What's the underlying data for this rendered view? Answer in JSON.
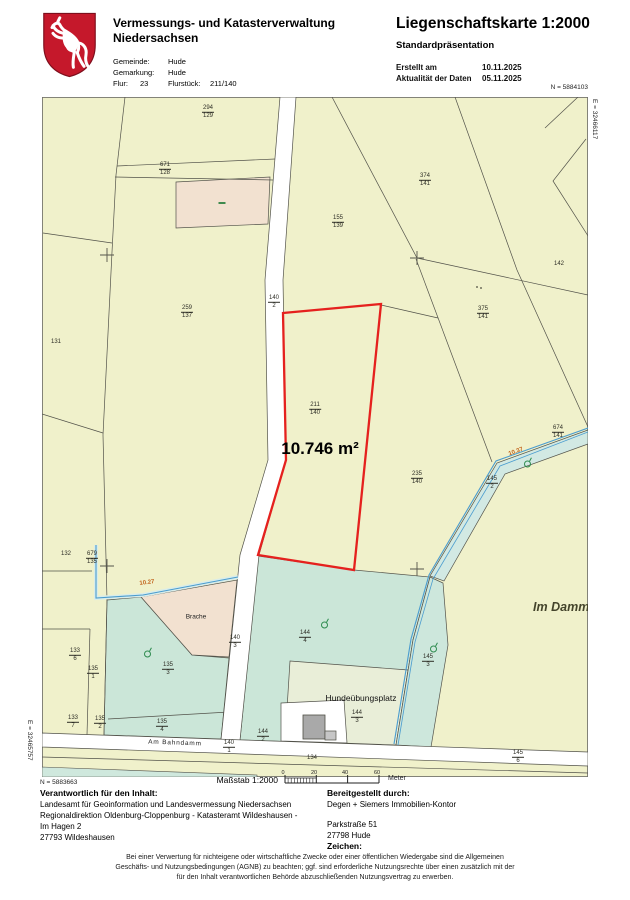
{
  "header": {
    "agency_line1": "Vermessungs- und Katasterverwaltung",
    "agency_line2": "Niedersachsen",
    "gemeinde_label": "Gemeinde:",
    "gemeinde": "Hude",
    "gemarkung_label": "Gemarkung:",
    "gemarkung": "Hude",
    "flur_label": "Flur:",
    "flur": "23",
    "flurstueck_label": "Flurstück:",
    "flurstueck": "211/140",
    "title": "Liegenschaftskarte 1:2000",
    "subtitle": "Standardpräsentation",
    "created_label": "Erstellt am",
    "created": "10.11.2025",
    "currency_label": "Aktualität der Daten",
    "currency": "05.11.2025"
  },
  "map": {
    "coords": {
      "n_top": "N = 5884103",
      "e_right": "E = 32466117",
      "e_left": "E = 32465757",
      "n_bottom": "N = 5883663"
    },
    "colors": {
      "map_background": "#f0f1cb",
      "grassland": "#cbe6d8",
      "bare_soil": "#f2e1d0",
      "water_line": "#4a9ccf",
      "highlight_outline": "#e5211e",
      "shield_red": "#c5182b"
    },
    "fraction_labels": [
      {
        "num": "294",
        "den": "129",
        "x": 166,
        "y": 15
      },
      {
        "num": "671",
        "den": "128",
        "x": 123,
        "y": 72
      },
      {
        "num": "374",
        "den": "141",
        "x": 383,
        "y": 83
      },
      {
        "num": "155",
        "den": "139",
        "x": 296,
        "y": 125
      },
      {
        "num": "259",
        "den": "137",
        "x": 145,
        "y": 215
      },
      {
        "num": "140",
        "den": "2",
        "x": 232,
        "y": 205
      },
      {
        "num": "375",
        "den": "141",
        "x": 441,
        "y": 216
      },
      {
        "num": "211",
        "den": "140",
        "x": 273,
        "y": 312
      },
      {
        "num": "674",
        "den": "141",
        "x": 516,
        "y": 335
      },
      {
        "num": "235",
        "den": "140",
        "x": 375,
        "y": 381
      },
      {
        "num": "145",
        "den": "2",
        "x": 450,
        "y": 386
      },
      {
        "num": "679",
        "den": "135",
        "x": 50,
        "y": 461
      },
      {
        "num": "135",
        "den": "3",
        "x": 126,
        "y": 572
      },
      {
        "num": "144",
        "den": "4",
        "x": 263,
        "y": 540
      },
      {
        "num": "140",
        "den": "3",
        "x": 193,
        "y": 545
      },
      {
        "num": "133",
        "den": "6",
        "x": 33,
        "y": 558
      },
      {
        "num": "135",
        "den": "1",
        "x": 51,
        "y": 576
      },
      {
        "num": "145",
        "den": "3",
        "x": 386,
        "y": 564
      },
      {
        "num": "144",
        "den": "3",
        "x": 315,
        "y": 620
      },
      {
        "num": "133",
        "den": "7",
        "x": 31,
        "y": 625
      },
      {
        "num": "135",
        "den": "2",
        "x": 58,
        "y": 626
      },
      {
        "num": "135",
        "den": "4",
        "x": 120,
        "y": 629
      },
      {
        "num": "140",
        "den": "1",
        "x": 187,
        "y": 650
      },
      {
        "num": "144",
        "den": "2",
        "x": 221,
        "y": 639
      },
      {
        "num": "145",
        "den": "6",
        "x": 476,
        "y": 660
      }
    ],
    "text_labels": [
      {
        "text": "142",
        "x": 517,
        "y": 167,
        "cls": "plain"
      },
      {
        "text": "131",
        "x": 14,
        "y": 245,
        "cls": "plain"
      },
      {
        "text": "132",
        "x": 24,
        "y": 457,
        "cls": "plain"
      },
      {
        "text": "134",
        "x": 270,
        "y": 661,
        "cls": "plain"
      },
      {
        "text": "Brache",
        "x": 154,
        "y": 520,
        "cls": "poi-small"
      },
      {
        "text": "Hundeübungsplatz",
        "x": 319,
        "y": 601,
        "cls": "poi-name"
      },
      {
        "text": "Im Dammb",
        "x": 523,
        "y": 510,
        "cls": "street-name"
      },
      {
        "text": "Am Bahndamm",
        "x": 133,
        "y": 646,
        "cls": "road-name",
        "rot": 2
      },
      {
        "text": "10.27",
        "x": 105,
        "y": 486,
        "cls": "measure",
        "rot": -7
      },
      {
        "text": "10.37",
        "x": 474,
        "y": 355,
        "cls": "measure",
        "rot": -20
      },
      {
        "text": "10.746 m²",
        "x": 278,
        "y": 352,
        "cls": "area-label"
      }
    ],
    "symbols": [
      {
        "type": "tree",
        "x": 106,
        "y": 555
      },
      {
        "type": "tree",
        "x": 283,
        "y": 526
      },
      {
        "type": "tree",
        "x": 392,
        "y": 550
      },
      {
        "type": "tree",
        "x": 486,
        "y": 365
      },
      {
        "type": "dash",
        "x": 180,
        "y": 106
      },
      {
        "type": "dots",
        "x": 435,
        "y": 190
      }
    ]
  },
  "scalebar": {
    "label": "Maßstab 1:2000",
    "t0": "0",
    "t20": "20",
    "t40": "40",
    "t60": "60",
    "unit": "Meter"
  },
  "footer": {
    "responsible": {
      "label": "Verantwortlich für den Inhalt:",
      "line1": "Landesamt für Geoinformation und Landesvermessung Niedersachsen",
      "line2": "Regionaldirektion Oldenburg-Cloppenburg - Katasteramt Wildeshausen -",
      "line3": "Im Hagen 2",
      "line4": "27793 Wildeshausen"
    },
    "provider": {
      "label": "Bereitgestellt durch:",
      "line1": "Degen + Siemers Immobilien-Kontor",
      "street": "Parkstraße 51",
      "city": "27798 Hude",
      "zeichen_label": "Zeichen:"
    },
    "disclaimer": "Bei einer Verwertung für nichteigene oder wirtschaftliche Zwecke oder einer öffentlichen Wiedergabe sind die Allgemeinen Geschäfts- und Nutzungsbedingungen (AGNB) zu beachten; ggf. sind erforderliche Nutzungsrechte über einen zusätzlich mit der für den Inhalt verantwortlichen Behörde abzuschließenden Nutzungsvertrag zu erwerben."
  }
}
